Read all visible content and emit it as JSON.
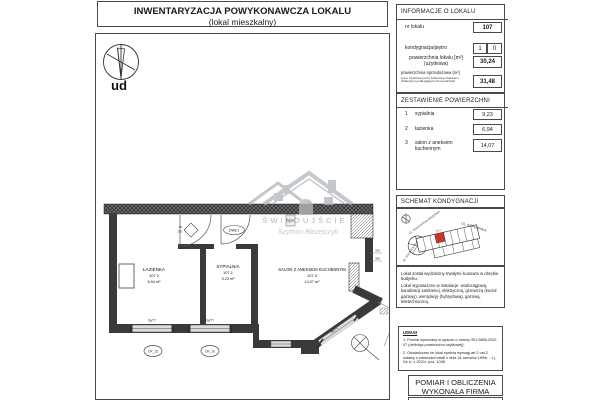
{
  "title": {
    "line1": "INWENTARYZACJA POWYKONAWCZA LOKALU",
    "line2": "(lokal mieszkalny)"
  },
  "info": {
    "header": "INFORMACJE O LOKALU",
    "nr_lokalu": {
      "label": "nr lokalu",
      "value": "107"
    },
    "kondygnacja": {
      "label": "kondygnacja/piętro",
      "value_left": "1",
      "value_right": "0"
    },
    "pow_uzytkowa": {
      "label": "powierzchnia lokalu [m²]",
      "sublabel": "(użytkowa)",
      "value": "30,24"
    },
    "pow_sprzedazowa": {
      "label": "powierzchnia sprzedażowa [m²]",
      "note": "(pow. użytkowa przed zabudową ściankami działowymi podlegającymi demontażowi)",
      "value": "31,48"
    }
  },
  "zestawienie": {
    "header": "ZESTAWIENIE POWIERZCHNI",
    "rows": [
      {
        "no": "1",
        "name": "sypialnia",
        "value": "9,23"
      },
      {
        "no": "2",
        "name": "łazienka",
        "value": "6,94"
      },
      {
        "no": "3",
        "name": "salon z aneksem kuchennym",
        "value": "14,07"
      }
    ]
  },
  "schemat": {
    "header": "SCHEMAT KONDYGNACJI",
    "streets": {
      "top": "UL. KOPERNIKA",
      "left": "UL. BOHATERÓW WRZEŚNIA",
      "bottom": "UL. SŁOWACKIEGO"
    },
    "unit_label": "107",
    "p1": "Lokal został wydzielony trwałymi ścianami w obrębie budynku.",
    "p2": "Lokal wyposażono w instalacje: wodociągową, kanalizacji sanitarnej, elektryczną, grzewczą (kocioł gazowy), wentylację (hybrydową), gazową, teletechniczną."
  },
  "uwagi": {
    "header": "UWAGI",
    "note1": "1. Pomiar wykonany w oparciu o normę ISO-9836:2022-07 (definicja powierzchni użytkowej).",
    "note2": "2. Oświadczam że lokal spełnia wymogi art.2 ust.2 ustawy o własności lokali z dnia 24 czerwca 1994r. - t.j. Dz.U. z 2021r. poz. 1048."
  },
  "pomiar": {
    "line1": "POMIAR I OBLICZENIA",
    "line2": "WYKONAŁA FIRMA"
  },
  "plan": {
    "compass_label": "pn",
    "rooms": [
      {
        "name": "ŁAZIENKA",
        "number": "107.2",
        "area": "6,94 m²"
      },
      {
        "name": "SYPIALNIA",
        "number": "107.1",
        "area": "9,23 m²"
      },
      {
        "name": "SALON Z ANEKSEM KUCHENNYM",
        "number": "107.3",
        "area": "14,07 m²"
      }
    ],
    "door_label": "DWe1",
    "door_width": "90",
    "door_height": "205",
    "sill_w1": "hp/77",
    "sill_w2": "hp/77",
    "sill_w3": "hp/75",
    "mark_w1": "OK_15",
    "mark_w2": "OK_16",
    "dim_1": "330",
    "dim_2": "385"
  },
  "watermark": {
    "city": "ŚWINOUJŚCIE",
    "signature": "Szymon Błażejczyk"
  },
  "colors": {
    "unit_red": "#c03a2b",
    "watermark_gray": "#b3b9bf"
  }
}
